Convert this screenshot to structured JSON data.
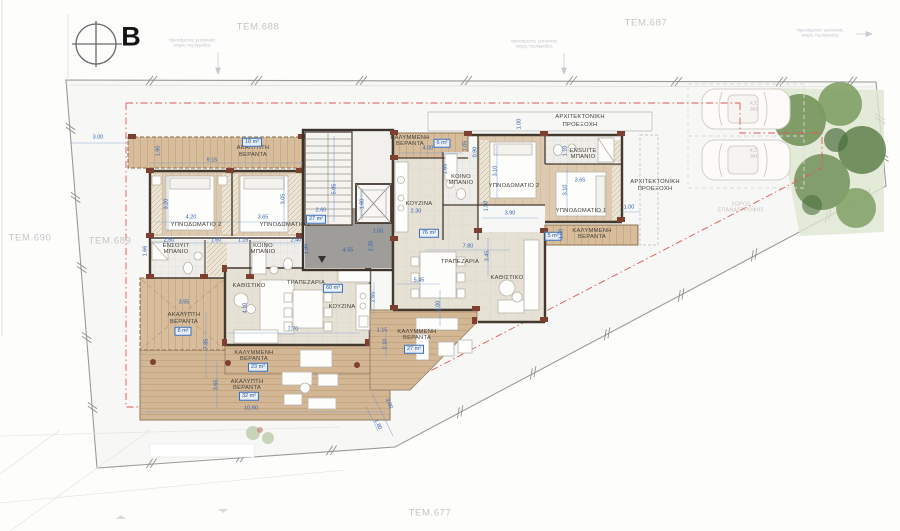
{
  "north": {
    "label": "B"
  },
  "parcels": {
    "p688": "ΤΕΜ.688",
    "p687": "ΤΕΜ.687",
    "p690": "ΤΕΜ.690",
    "p689": "ΤΕΜ.689",
    "p677": "ΤΕΜ.677"
  },
  "site_notes": {
    "fence_line1": "Υφιστάμενος γειτονικός",
    "fence_line2": "τοίχος περίφραξης",
    "turning_line1": "ΧΩΡΟΣ",
    "turning_line2": "ΕΠΑΝΑΣΤΡΟΦΗΣ"
  },
  "parking": {
    "space1_code": "Χ.Σ.",
    "space1_num": "302",
    "space2_code": "Χ.Σ.",
    "space2_num": "301"
  },
  "core": {
    "area": "27 m²",
    "dims": {
      "w": "2.60",
      "h": "5.05",
      "lift": "1.60",
      "d1": "1.50",
      "d2": "4.55",
      "d3": "2.20"
    }
  },
  "unit_a": {
    "veranda_top": {
      "name1": "ΑΚΑΛΥΠΤΗ",
      "name2": "ΒΕΡΑΝΤΑ",
      "area": "18 m²",
      "w": "9.15",
      "h": "1.90",
      "setback": "3.00"
    },
    "bedroom2": {
      "name": "ΥΠΝΟΔΩΜΑΤΙΟ 2",
      "w": "4.20",
      "h": "3.20"
    },
    "bedroom1": {
      "name": "ΥΠΝΟΔΩΜΑΤΙΟ 1",
      "w": "3.65",
      "h": "3.05"
    },
    "ensuite": {
      "name1": "ΕΝΣΟΥΙΤ",
      "name2": "ΜΠΑΝΙΟ",
      "w": "2.50",
      "h": "1.66"
    },
    "bath": {
      "name1": "ΚΟΙΝΟ",
      "name2": "ΜΠΑΝΙΟ",
      "w": "2.40",
      "h": "1.80",
      "d1": "1.60",
      "d2": "1.15"
    },
    "living": {
      "name": "ΚΑΘΙΣΤΙΚΟ",
      "h": "4.10"
    },
    "dining": {
      "name": "ΤΡΑΠΕΖΑΡΙΑ",
      "area": "60 m²",
      "w": "7.70"
    },
    "kitchen": {
      "name": "ΚΟΥΖΙΝΑ"
    },
    "veranda_side": {
      "name1": "ΑΚΑΛΥΠΤΗ",
      "name2": "ΒΕΡΑΝΤΑ",
      "area": "8 m²",
      "w": "3.55",
      "h": "7.85"
    },
    "veranda_cov": {
      "name1": "ΚΑΛΥΜΜΕΝΗ",
      "name2": "ΒΕΡΑΝΤΑ",
      "area": "23 m²"
    },
    "veranda_bottom": {
      "name1": "ΑΚΑΛΥΠΤΗ",
      "name2": "ΒΕΡΑΝΤΑ",
      "area": "32 m²",
      "w": "10.90",
      "h": "3.65"
    }
  },
  "unit_b": {
    "veranda_top": {
      "name1": "ΚΑΛΥΜΜΕΝΗ",
      "name2": "ΒΕΡΑΝΤΑ",
      "area": "6 m²",
      "w": "4.00",
      "h": "1.05",
      "d": "0.90"
    },
    "arch_top": {
      "name1": "ΑΡΧΙΤΕΚΤΟΝΙΚΗ",
      "name2": "ΠΡΟΕΞΟΧΗ",
      "offset": "1.00"
    },
    "kitchen": {
      "name": "ΚΟΥΖΙΝΑ",
      "w": "2.30"
    },
    "bath": {
      "name1": "ΚΟΙΝΟ",
      "name2": "ΜΠΑΝΙΟ",
      "h": "1.65"
    },
    "bedroom2": {
      "name": "ΥΠΝΟΔΩΜΑΤΙΟ 2",
      "w": "3.90",
      "h": "3.10",
      "d": "1.50"
    },
    "ensuite": {
      "name1": "ENSUITE",
      "name2": "ΜΠΑΝΙΟ",
      "h": "1.10"
    },
    "bedroom1": {
      "name": "ΥΠΝΟΔΩΜΑΤΙΟ 1",
      "w": "3.65",
      "h": "3.10",
      "offset": "1.00"
    },
    "arch_right": {
      "name1": "ΑΡΧΙΤΕΚΤΟΝΙΚΗ",
      "name2": "ΠΡΟΕΞΟΧΗ"
    },
    "veranda_right": {
      "name1": "ΚΑΛΥΜΜΕΝΗ",
      "name2": "ΒΕΡΑΝΤΑ",
      "area": "5 m²",
      "h": "1.00"
    },
    "dining": {
      "name": "ΤΡΑΠΕΖΑΡΙΑ",
      "area": "76 m²",
      "w": "7.80"
    },
    "living": {
      "name": "ΚΑΘΙΣΤΙΚΟ",
      "h": "3.45"
    },
    "veranda_main": {
      "name1": "ΚΑΛΥΜΜΕΝΗ",
      "name2": "ΒΕΡΑΝΤΑ",
      "area": "27 m²",
      "w": "5.45",
      "h1": "2.65",
      "h2": "4.00",
      "d1": "1.15",
      "d2": "2.10",
      "s1": "3.00",
      "s2": "1.80"
    }
  }
}
